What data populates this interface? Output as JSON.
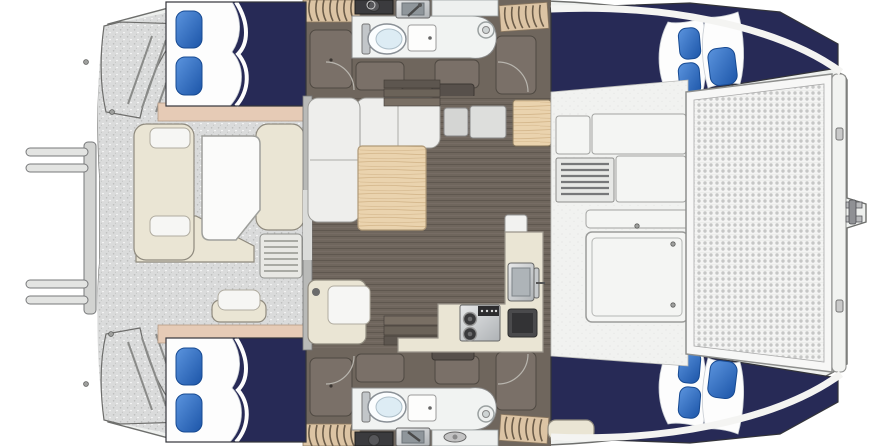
{
  "palette": {
    "background": "#ffffff",
    "navy": "#272a56",
    "pillowHi": "#5b94de",
    "pillowLo": "#1c55a8",
    "pillowEdge": "#174a92",
    "tan": "#e6cbb6",
    "cream": "#eae5d4",
    "wood": "#ead3ae",
    "woodLine": "#d6b98e",
    "floor": "#6f665d",
    "floorLine": "#5f574f",
    "deck": "#dadbdb",
    "deckDot": "#bcbdbc",
    "deckWhite": "#f1f2f0",
    "meshBg": "#f4f4f3",
    "meshDot": "#c6c7c6",
    "steelHi": "#e8e9ea",
    "steelLo": "#aeb2b5",
    "slatTan": "#dcc4a4",
    "slatLine": "#6b5c49",
    "darkBox": "#3b3b3e",
    "wardrobe": "#7a7068",
    "wardrobeLine": "#4f4942",
    "outline": "#6e6f6d"
  },
  "plan": {
    "type": "catamaran-floorplan",
    "bow_side": "right",
    "hull_count": 2,
    "cabins": [
      {
        "id": "cabin-top-aft",
        "position": "top-left",
        "pillow_count": 2
      },
      {
        "id": "cabin-top-forward",
        "position": "top-right",
        "pillow_count": 3
      },
      {
        "id": "cabin-bottom-aft",
        "position": "bottom-left",
        "pillow_count": 2
      },
      {
        "id": "cabin-bottom-forward",
        "position": "bottom-right",
        "pillow_count": 3
      }
    ],
    "heads": [
      {
        "id": "head-top",
        "position": "top-center",
        "fixtures": [
          "toilet",
          "shower-unit",
          "drain",
          "vanity-sink",
          "vanity-cabinet"
        ]
      },
      {
        "id": "head-bottom",
        "position": "bottom-center",
        "fixtures": [
          "toilet",
          "shower-unit",
          "drain",
          "vanity-sink",
          "vanity-cabinet"
        ]
      }
    ],
    "saloon": {
      "furniture": [
        "l-settee",
        "dining-table",
        "companionway-steps",
        "cabinets"
      ]
    },
    "galley": {
      "appliances": [
        "stove",
        "sink",
        "icebox"
      ]
    },
    "cockpit": {
      "furniture": [
        "u-settee",
        "cockpit-table",
        "helm-seat",
        "deck-grate"
      ]
    },
    "foredeck": {
      "features": [
        "trampoline",
        "deck-hatch",
        "louvered-vent",
        "bow-crossbeam",
        "anchor-fitting"
      ]
    },
    "stern": {
      "features": [
        "transom-steps-top",
        "transom-steps-bottom",
        "boarding-ladder",
        "cleat"
      ]
    }
  }
}
